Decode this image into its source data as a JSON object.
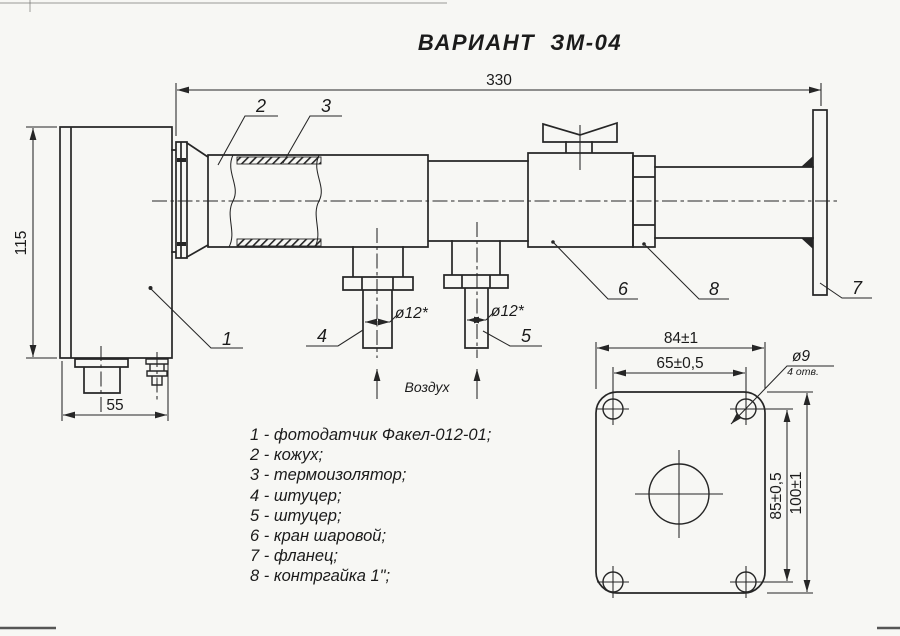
{
  "title": "ВАРИАНТ  ЗМ-04",
  "colors": {
    "background": "#f7f7f4",
    "line": "#262626",
    "text": "#1b1b1b"
  },
  "main_view": {
    "dim_overall_length": "330",
    "dim_body_height": "115",
    "dim_body_depth": "55",
    "dim_fitting4_bore": "ø12*",
    "dim_fitting5_bore": "ø12*",
    "air_label": "Воздух",
    "callouts": [
      "1",
      "2",
      "3",
      "4",
      "5",
      "6",
      "7",
      "8"
    ]
  },
  "parts_list": [
    "1 - фотодатчик Факел-012-01;",
    "2 - кожух;",
    "3 - термоизолятор;",
    "4 - штуцер;",
    "5 - штуцер;",
    "6 - кран шаровой;",
    "7 - фланец;",
    "8 - контргайка 1\";"
  ],
  "flange_view": {
    "dim_width": "84±1",
    "dim_hole_spacing_horizontal": "65±0,5",
    "dim_hole_diameter": "ø9",
    "hole_count_note": "4 отв.",
    "dim_hole_spacing_vertical": "85±0,5",
    "dim_height": "100±1"
  }
}
